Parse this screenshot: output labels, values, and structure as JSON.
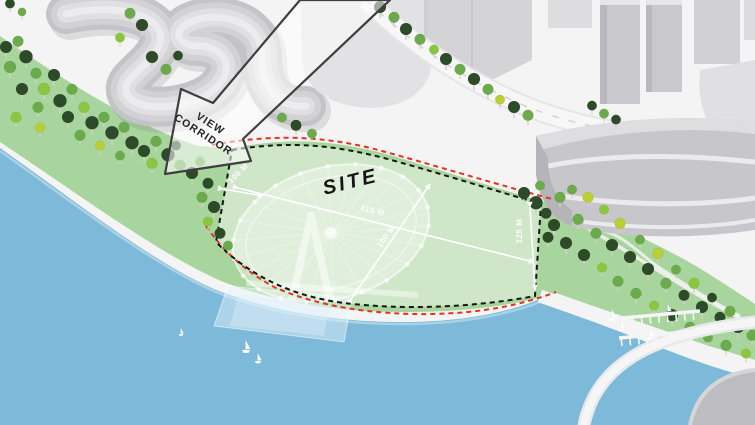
{
  "diagram": {
    "site_label": "SITE",
    "view_corridor_label": {
      "line1": "VIEW",
      "line2": "CORRIDOR"
    },
    "dimensions": {
      "length": "315 M",
      "width_left": "100 M",
      "width_middle": "100 M",
      "width_right": "125 M"
    },
    "colors": {
      "water": "#7db9d8",
      "park_green": "#a8d59d",
      "site_green": "#cfe6c8",
      "site_boundary_dash": "#161616",
      "setback_dash_red": "#e8301f",
      "dimension_white": "#ffffff",
      "building_gray": "#c9c9cd",
      "ground": "#f4f4f5"
    }
  }
}
